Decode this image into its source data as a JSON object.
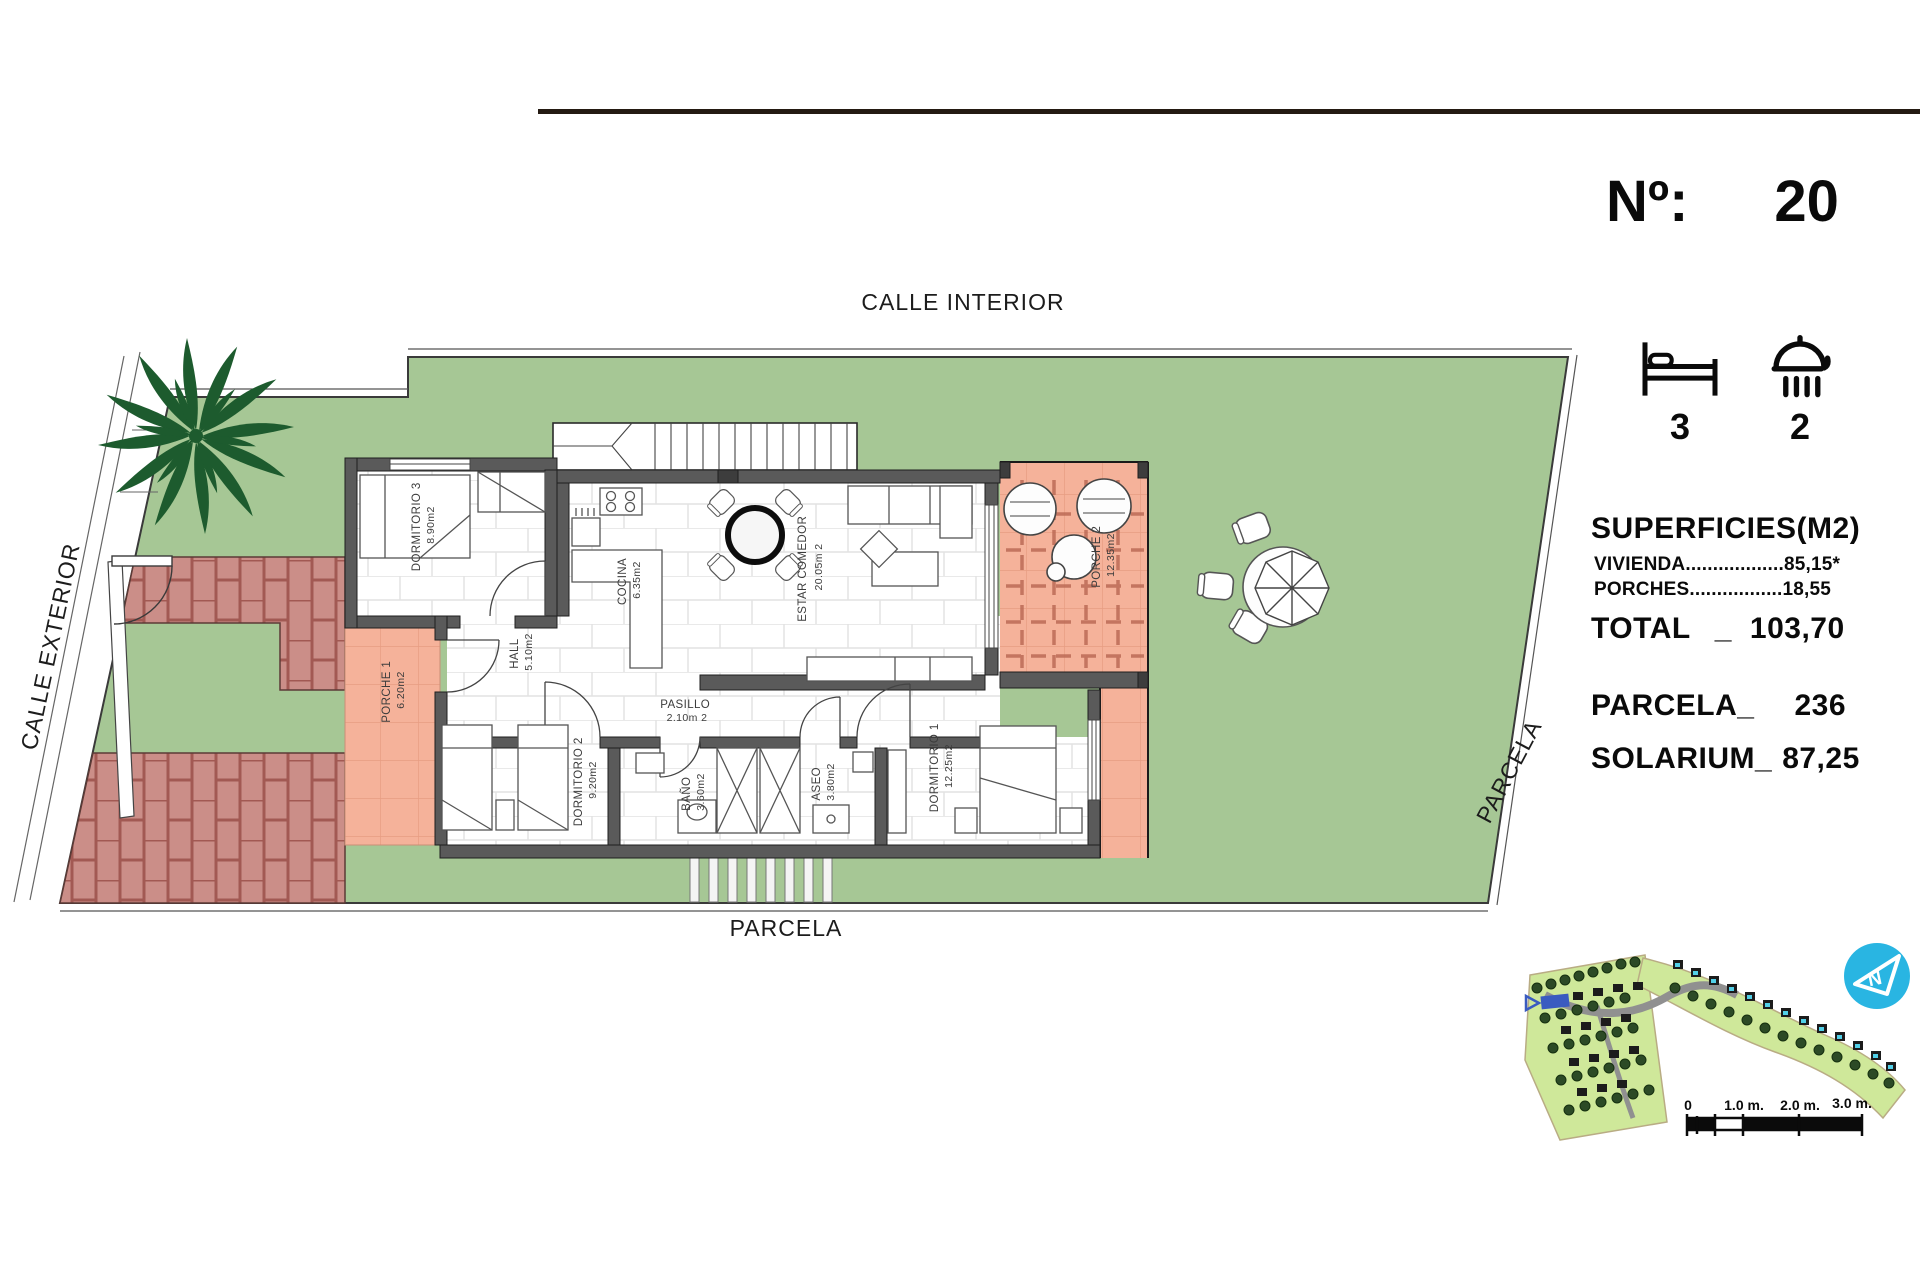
{
  "plot": {
    "number_label": "Nº:",
    "number": "20"
  },
  "features": {
    "bedrooms": "3",
    "bathrooms": "2",
    "bed_icon": "bed-icon",
    "shower_icon": "shower-icon"
  },
  "surfaces": {
    "title": "SUPERFICIES(M2)",
    "vivienda_line": "VIVIENDA..................85,15*",
    "porches_line": "PORCHES.................18,55",
    "total_label": "TOTAL",
    "total_separator": "_",
    "total_value": "103,70",
    "parcela_label": "PARCELA_",
    "parcela_value": "236",
    "solarium_label": "SOLARIUM_",
    "solarium_value": "87,25"
  },
  "streets": {
    "top": "CALLE INTERIOR",
    "left": "CALLE EXTERIOR",
    "right": "PARCELA",
    "bottom": "PARCELA"
  },
  "rooms": {
    "dormitorio3": {
      "name": "DORMITORIO 3",
      "area": "8.90m2"
    },
    "cocina": {
      "name": "COCINA",
      "area": "6.35m2"
    },
    "estar": {
      "name": "ESTAR COMEDOR",
      "area": "20.05m 2"
    },
    "porche2": {
      "name": "PORCHE 2",
      "area": "12.35m2"
    },
    "hall": {
      "name": "HALL",
      "area": "5.10m2"
    },
    "porche1": {
      "name": "PORCHE 1",
      "area": "6.20m2"
    },
    "pasillo": {
      "name": "PASILLO",
      "area": "2.10m 2"
    },
    "dormitorio2": {
      "name": "DORMITORIO 2",
      "area": "9.20m2"
    },
    "bano": {
      "name": "BAÑO",
      "area": "3.60m2"
    },
    "aseo": {
      "name": "ASEO",
      "area": "3.80m2"
    },
    "dormitorio1": {
      "name": "DORMITORIO 1",
      "area": "12.25m2"
    }
  },
  "scale_bar": {
    "ticks": [
      "0",
      "1.0 m.",
      "2.0 m.",
      "3.0 m."
    ]
  },
  "colors": {
    "grass": "#a6c795",
    "porch": "#f5b29a",
    "brick_fill": "#cb8e88",
    "brick_line": "#a25953",
    "wall": "#5a5a5a",
    "map_green": "#cfe89a",
    "map_accent": "#29b5e2",
    "plot_highlight": "#3a5bc0"
  }
}
